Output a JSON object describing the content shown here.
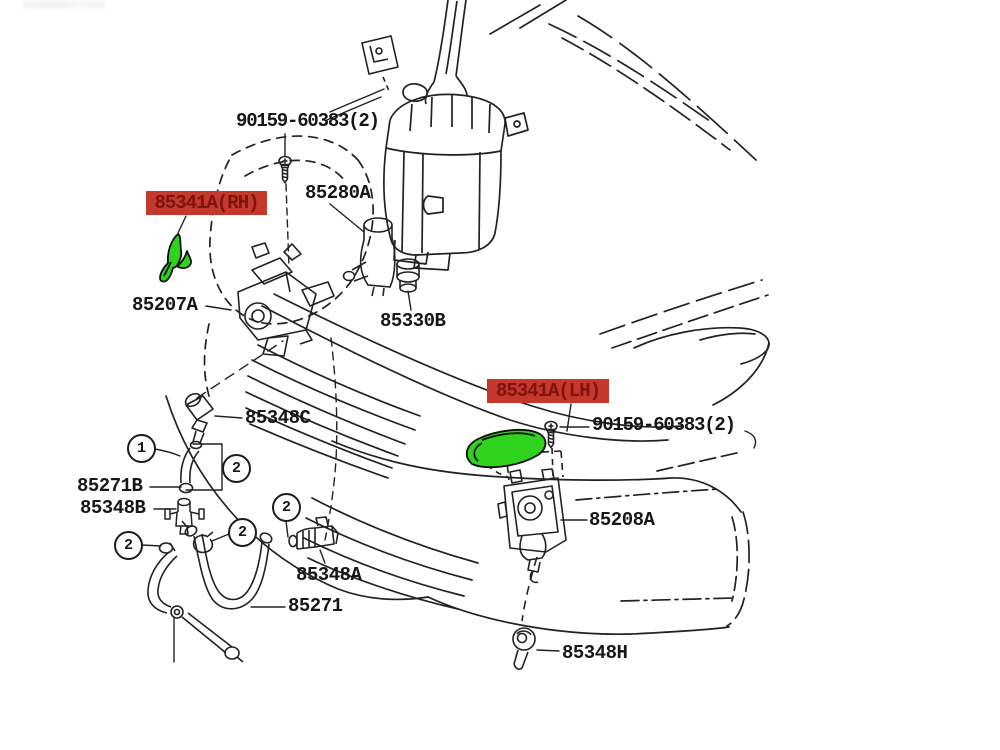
{
  "diagram": {
    "type": "parts-diagram",
    "subject": "headlamp washer system exploded parts diagram",
    "colors": {
      "background": "#ffffff",
      "line": "#222222",
      "highlight_label_bg": "#c4392b",
      "highlight_label_text": "#7e120e",
      "highlighted_part_fill": "#2fd31d"
    },
    "labels": {
      "bolt_top": "90159-60383(2)",
      "reservoir_pump": "85280A",
      "cover_rh": "85341A(RH)",
      "actuator_rh": "85207A",
      "grommet_330": "85330B",
      "cover_lh": "85341A(LH)",
      "bolt_right": "90159-60383(2)",
      "joint_348c": "85348C",
      "hose_271b": "85271B",
      "valve_348b": "85348B",
      "actuator_lh": "85208A",
      "nozzle_348a": "85348A",
      "hose_271": "85271",
      "grommet_348h": "85348H"
    },
    "callouts": {
      "one": "1",
      "two": "2"
    }
  }
}
